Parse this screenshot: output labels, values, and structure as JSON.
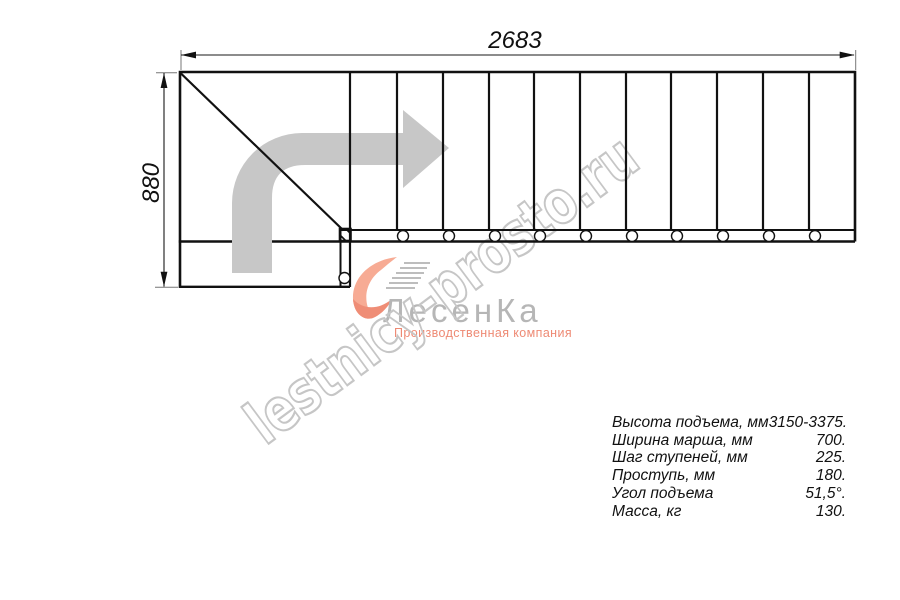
{
  "drawing": {
    "type": "stair-plan-top-view",
    "width_dim": "2683",
    "height_dim": "880",
    "arrow_icon": "turn-right-direction-arrow",
    "tread_lines": 11,
    "accent_gray": "#c7c7c7",
    "line_color": "#111111"
  },
  "watermark": {
    "text": "lestnicy-prosto.ru",
    "color": "#c6c6c6"
  },
  "logo": {
    "company": "ЛесенКа",
    "tagline": "Производственная компания",
    "mark_icon": "swoosh-stairs-logo",
    "accent_color": "#f5a68e",
    "text_color": "#b6b6b6"
  },
  "specs": {
    "rows": [
      {
        "label": "Высота подъема, мм",
        "value": "3150-3375."
      },
      {
        "label": "Ширина марша, мм",
        "value": "700."
      },
      {
        "label": "Шаг ступеней, мм",
        "value": "225."
      },
      {
        "label": "Проступь, мм",
        "value": "180."
      },
      {
        "label": "Угол подъема",
        "value": "51,5°."
      },
      {
        "label": "Масса, кг",
        "value": "130."
      }
    ]
  }
}
